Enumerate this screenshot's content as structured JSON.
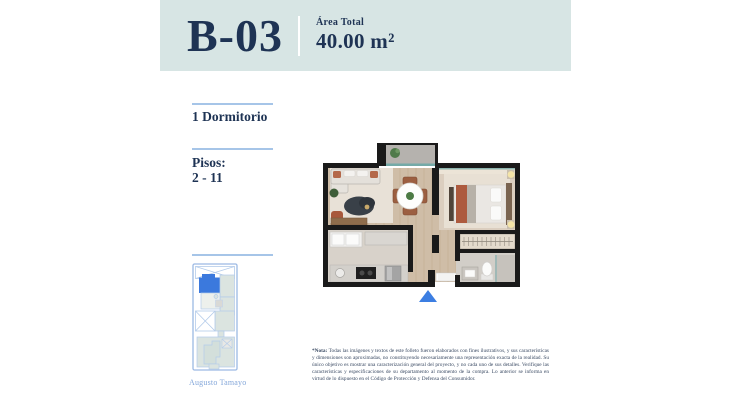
{
  "header": {
    "unit": "B-03",
    "area_label": "Área Total",
    "area_value": "40.00 m²"
  },
  "specs": {
    "bedrooms": "1 Dormitorio",
    "floors_label": "Pisos:",
    "floors_range": "2 - 11"
  },
  "keyplan": {
    "street": "Augusto Tamayo",
    "highlight_color": "#3b79dd",
    "outline_color": "#9cb9e3"
  },
  "floorplan": {
    "entrance_marker_color": "#3c7ee2"
  },
  "note": {
    "label": "*Nota:",
    "text": " Todas las imágenes y textos de este folleto fueron elaborados con fines ilustrativos, y sus características y dimensiones son aproximadas, no constituyendo necesariamente una representación exacta de la realidad. Su único objetivo es mostrar una caracterización general del proyecto, y no cada uno de sus detalles. Verifique las características y especificaciones de su departamento al momento de la compra. Lo anterior se informa en virtud de lo dispuesto en el Código de Protección y Defensa del Consumidor."
  },
  "colors": {
    "header_bg": "#d7e5e4",
    "navy": "#1e3354",
    "rule_blue": "#a6c5e8",
    "street_label_blue": "#84a7da"
  }
}
